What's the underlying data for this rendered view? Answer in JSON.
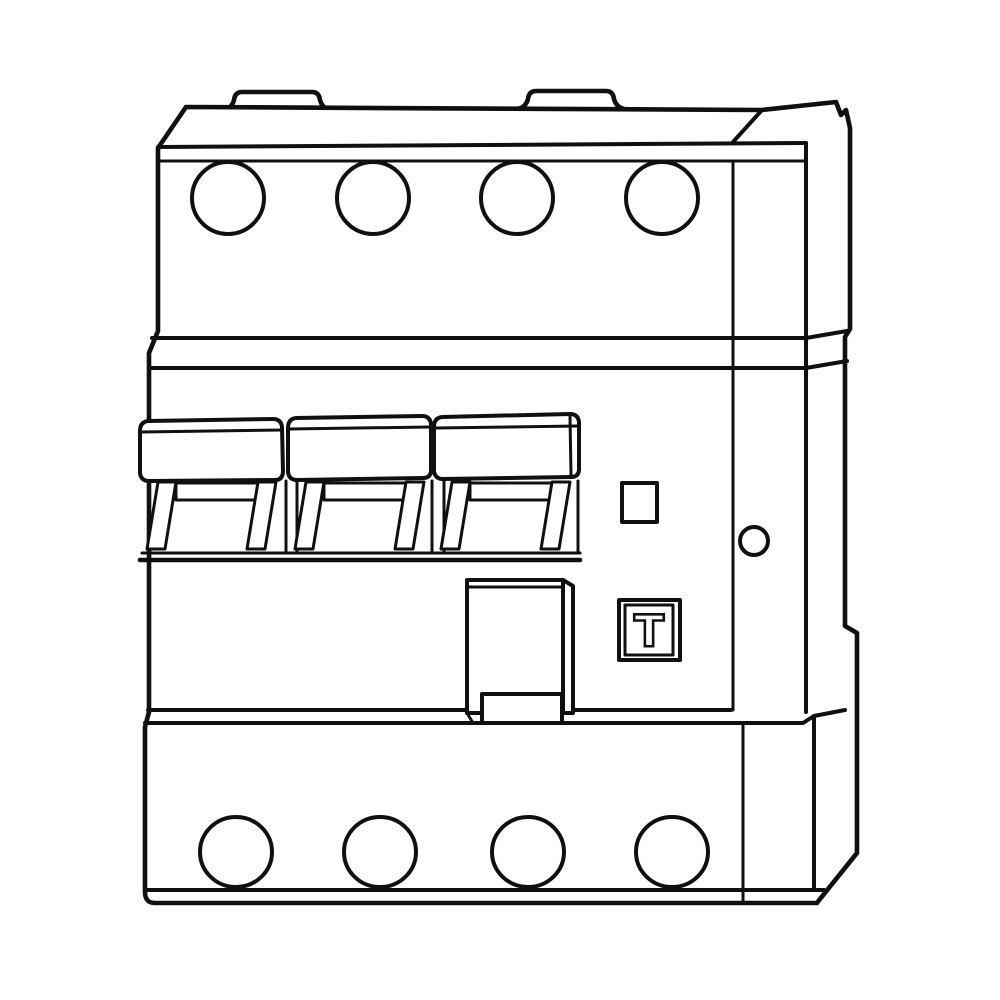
{
  "canvas": {
    "background_color": "#ffffff",
    "line_color": "#101010",
    "fill_color": "#ffffff"
  },
  "figure": {
    "kind": "technical-line-drawing",
    "subject": "modular 4-pole residual-current circuit breaker, front three-quarter view",
    "mounting_tabs_top": 2,
    "terminal_holes_top": 4,
    "terminal_holes_bottom": 4,
    "toggle_levers": 3,
    "indicator_window": "small unlabeled square",
    "side_rivet_hole": "small circle on right flange",
    "test_button": {
      "label": "T"
    }
  }
}
